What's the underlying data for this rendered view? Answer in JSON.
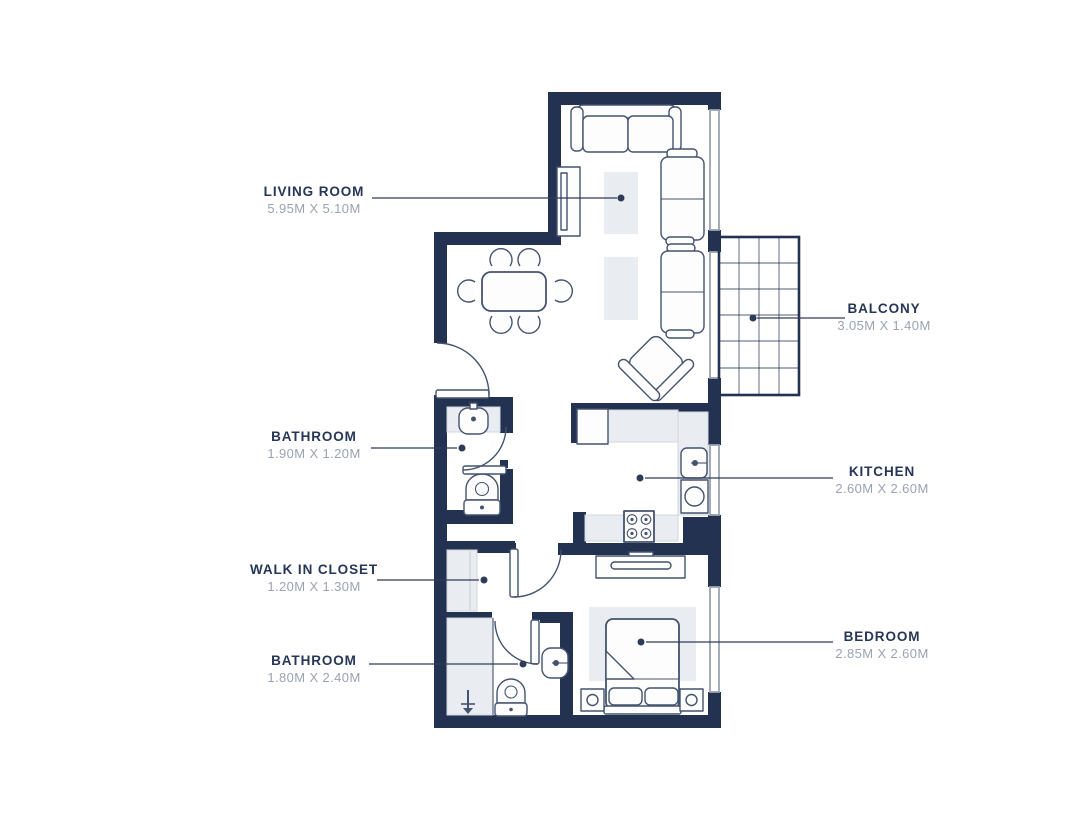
{
  "colors": {
    "wall": "#233250",
    "outline": "#44536f",
    "light": "#e9ecf0",
    "window": "#9aa3af",
    "label": "#263657",
    "dims": "#9aa3b2",
    "leader": "#2e3b58",
    "bg": "#ffffff"
  },
  "rooms": [
    {
      "id": "living-room",
      "name": "LIVING ROOM",
      "dims": "5.95M X 5.10M",
      "label_side": "left"
    },
    {
      "id": "balcony",
      "name": "BALCONY",
      "dims": "3.05M X 1.40M",
      "label_side": "right"
    },
    {
      "id": "bathroom-1",
      "name": "BATHROOM",
      "dims": "1.90M X 1.20M",
      "label_side": "left"
    },
    {
      "id": "kitchen",
      "name": "KITCHEN",
      "dims": "2.60M X 2.60M",
      "label_side": "right"
    },
    {
      "id": "walk-in-closet",
      "name": "WALK IN CLOSET",
      "dims": "1.20M X 1.30M",
      "label_side": "left"
    },
    {
      "id": "bathroom-2",
      "name": "BATHROOM",
      "dims": "1.80M X 2.40M",
      "label_side": "left"
    },
    {
      "id": "bedroom",
      "name": "BEDROOM",
      "dims": "2.85M X 2.60M",
      "label_side": "right"
    }
  ]
}
